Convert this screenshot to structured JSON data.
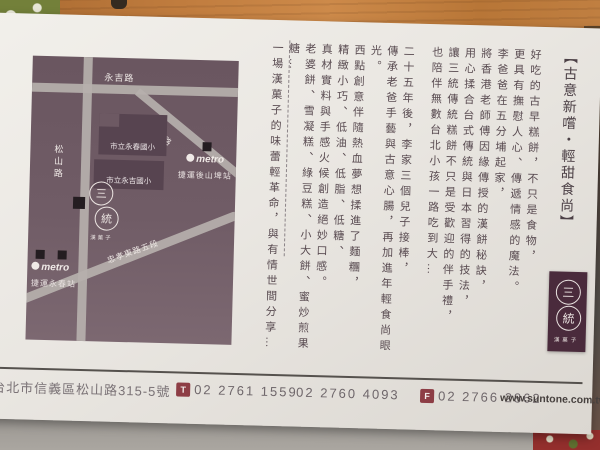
{
  "title": "【古意新嚐・輕甜食尚】",
  "story": {
    "lines": [
      "好吃的古早糕餅，不只是食物，",
      "更具有撫慰人心、傳遞情感的魔法。",
      "李爸爸在五分埔起家，",
      "將香港老師傅因緣傳授的漢餅秘訣，",
      "用心揉合台式傳統與日本習得的技法，",
      "讓三統傳統糕餅不只是受歡迎的伴手禮，",
      "也陪伴無數台北小孩一路吃到大…",
      "二十五年後，李家三個兒子接棒，",
      "傳承老爸手藝與古意心腸，再加進年輕食尚眼光。",
      "西點創意伴隨熱血夢想揉進了麵糰，",
      "精緻小巧、低油、低脂、低糖、",
      "真材實料與手感火候創造絕妙口感。",
      "老婆餅、雪凝糕、綠豆糕、小大餅、蜜炒煎果糖…",
      "一場漢菓子的味蕾輕革命，與有情世間分享…"
    ]
  },
  "map": {
    "roads": [
      {
        "label": "永吉路"
      },
      {
        "label": "松山路"
      },
      {
        "label": "中坡北路"
      },
      {
        "label": "忠孝東路五段"
      }
    ],
    "buildings": [
      "市立永春國小",
      "市立永吉國小"
    ],
    "metro_wordmark": "metro",
    "stations": [
      {
        "name": "捷運後山埤站"
      },
      {
        "name": "捷運永春站"
      }
    ],
    "store": {
      "circle_top": "三",
      "circle_bottom": "統",
      "caption": "漢菓子"
    }
  },
  "brand": {
    "circle_top": "三",
    "circle_bottom": "統",
    "caption": "漢菓子",
    "website": "www.suntone.com.tw"
  },
  "contact": {
    "address": "台北市信義區松山路315-5號",
    "tel_badge": "T",
    "tel_1": "02 2761 1559",
    "tel_2": "02 2760 4093",
    "fax_badge": "F",
    "fax": "02 2766 2862"
  },
  "colors": {
    "map_bg": "#6d5963",
    "banner_bg": "#4a2b3c",
    "badge_bg": "#8d3d45",
    "card_bg": "#eae7e2",
    "story_text": "#594b51"
  }
}
